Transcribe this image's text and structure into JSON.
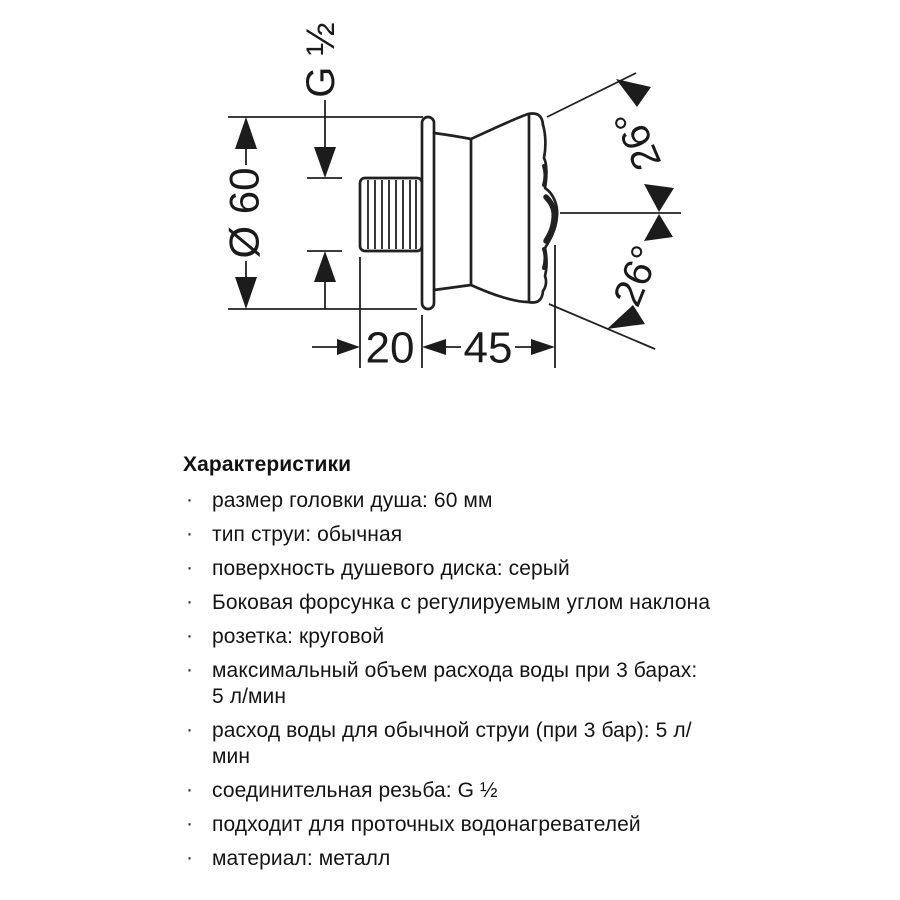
{
  "diagram": {
    "labels": {
      "thread": "G ½",
      "diameter": "Ø 60",
      "depth": "20",
      "length": "45",
      "angle_upper": "26°",
      "angle_lower": "26°"
    }
  },
  "specs": {
    "heading": "Характеристики",
    "bullet": "·",
    "items": [
      "размер головки душа: 60 мм",
      "тип струи: обычная",
      "поверхность душевого диска: серый",
      "Боковая форсунка с регулируемым углом наклона",
      "розетка: круговой",
      "максимальный объем расхода воды при 3 барах:\n5 л/мин",
      "расход воды для обычной струи (при 3 бар): 5 л/\nмин",
      "соединительная резьба: G ½",
      "подходит для проточных водонагревателей",
      "материал: металл"
    ]
  },
  "colors": {
    "ink": "#212121",
    "background": "#ffffff"
  }
}
